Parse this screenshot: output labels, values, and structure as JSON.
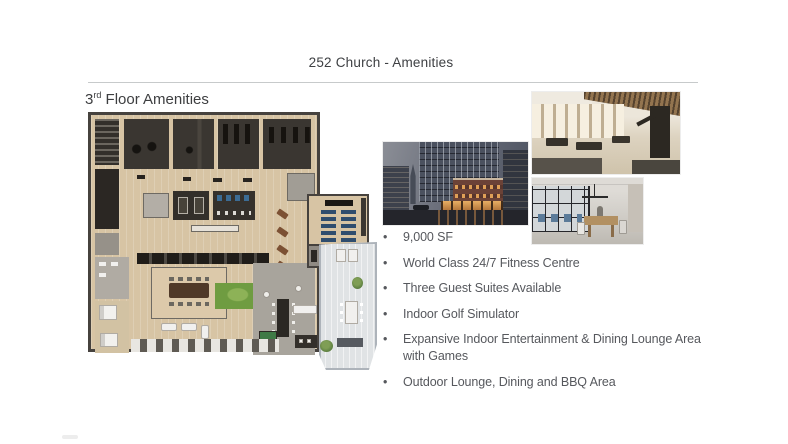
{
  "slide": {
    "title": "252 Church - Amenities",
    "heading": {
      "base": "3",
      "superscript": "rd",
      "rest": " Floor Amenities"
    },
    "bullet_char": "•",
    "bullets": [
      {
        "lines": [
          "9,000 SF"
        ]
      },
      {
        "lines": [
          "World Class 24/7 Fitness Centre"
        ]
      },
      {
        "lines": [
          "Three Guest Suites Available"
        ]
      },
      {
        "lines": [
          "Indoor Golf Simulator"
        ]
      },
      {
        "lines": [
          "Expansive Indoor Entertainment & Dining Lounge Area",
          "with Games"
        ]
      },
      {
        "lines": [
          "Outdoor Lounge, Dining and BBQ Area"
        ]
      }
    ],
    "images": [
      {
        "name": "floor-plan",
        "alt": "3rd floor amenities floor plan rendering"
      },
      {
        "name": "exterior-night",
        "alt": "252 Church building exterior at dusk"
      },
      {
        "name": "fitness-centre",
        "alt": "World class fitness centre interior rendering"
      },
      {
        "name": "indoor-lounge",
        "alt": "Indoor lounge with glass partitions rendering"
      }
    ],
    "colors": {
      "text": "#56585d",
      "divider": "#c7cacb",
      "plan_wood": "#d7c4a4",
      "plan_dark_room": "#3a3631",
      "golf_turf_green": "#6f9c41",
      "terrace_deck": "#e0e3e5",
      "theatre_seat_blue": "#2f4d6e"
    }
  }
}
